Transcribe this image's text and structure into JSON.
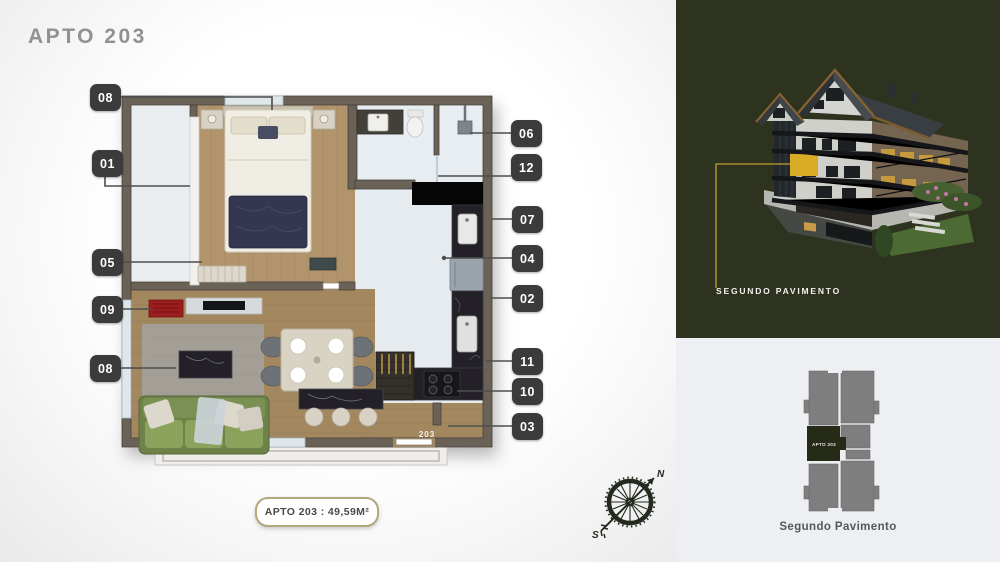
{
  "sheet": {
    "title": "APTO 203",
    "area_badge": "APTO 203 : 49,59M²",
    "floor_unit_tag": "203"
  },
  "plan_tags": {
    "left": [
      "08",
      "01",
      "05",
      "09",
      "08"
    ],
    "right": [
      "06",
      "12",
      "07",
      "04",
      "02",
      "11",
      "10",
      "03"
    ]
  },
  "compass": {
    "north": "N",
    "south": "S"
  },
  "right_panels": {
    "building": {
      "caption": "SEGUNDO PAVIMENTO"
    },
    "keyplan": {
      "caption": "Segundo Pavimento",
      "highlight_label": "APTO 203"
    }
  },
  "colors": {
    "accent_yellow": "#d9ac25",
    "callout_line": "#a68c2d",
    "olive_panel": "#2e331f",
    "light_panel": "#edeff3",
    "tag_chip": "#3b3b3b",
    "keyplan_gray": "#7e7e7e",
    "keyplan_highlight": "#262b18",
    "badge_border": "#b3a77c"
  }
}
